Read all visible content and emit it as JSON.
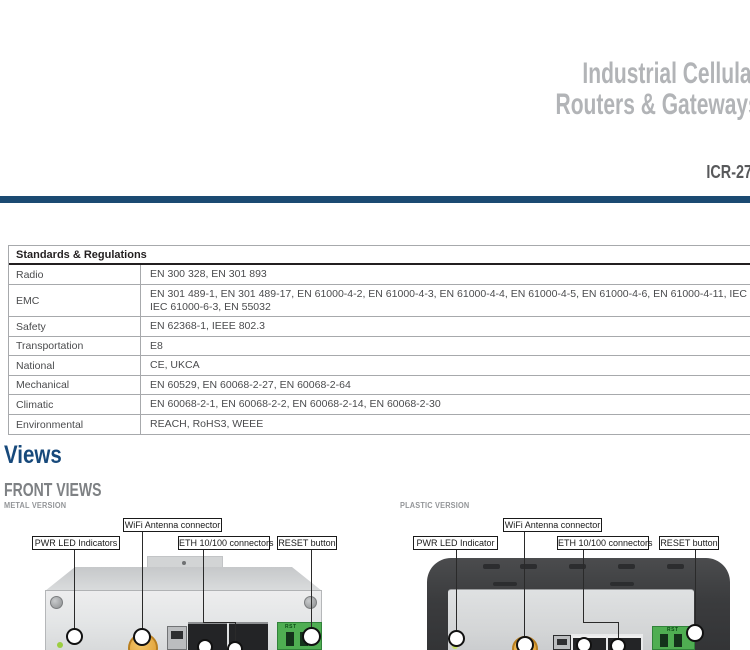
{
  "header": {
    "title_line1": "Industrial Cellular",
    "title_line2": "Routers & Gateways",
    "model": "ICR-27"
  },
  "colors": {
    "accent_navy": "#1B4A72",
    "title_gray": "#B2B4B7",
    "model_gray": "#58595B",
    "section_blue": "#17497B",
    "subheading_gray": "#7E8184",
    "terminal_green": "#4FAE52",
    "antenna_orange": "#DD9A2E"
  },
  "standards_table": {
    "title": "Standards & Regulations",
    "rows": [
      {
        "label": "Radio",
        "value": "EN 300 328, EN 301 893"
      },
      {
        "label": "EMC",
        "value": "EN 301 489-1, EN 301 489-17, EN 61000-4-2, EN 61000-4-3, EN 61000-4-4, EN 61000-4-5, EN 61000-4-6, EN 61000-4-11, IEC 61000-6-2,",
        "value2": "IEC 61000-6-3, EN 55032"
      },
      {
        "label": "Safety",
        "value": "EN 62368-1, IEEE 802.3"
      },
      {
        "label": "Transportation",
        "value": "E8"
      },
      {
        "label": "National",
        "value": "CE, UKCA"
      },
      {
        "label": "Mechanical",
        "value": "EN 60529, EN 60068-2-27, EN 60068-2-64"
      },
      {
        "label": "Climatic",
        "value": "EN 60068-2-1, EN 60068-2-2, EN 60068-2-14, EN 60068-2-30"
      },
      {
        "label": "Environmental",
        "value": "REACH, RoHS3, WEEE"
      }
    ]
  },
  "views": {
    "section_title": "Views",
    "subsection_title": "FRONT VIEWS",
    "metal": {
      "variant_label": "METAL VERSION",
      "callout_pwr": "PWR LED Indicators",
      "callout_wifi": "WiFi Antenna connector",
      "callout_eth": "ETH 10/100 connectors",
      "callout_reset": "RESET button",
      "terminal_label": "RST"
    },
    "plastic": {
      "variant_label": "PLASTIC VERSION",
      "callout_pwr": "PWR LED Indicator",
      "callout_wifi": "WiFi Antenna connector",
      "callout_eth": "ETH 10/100 connectors",
      "callout_reset": "RESET button",
      "terminal_label": "RST"
    }
  }
}
